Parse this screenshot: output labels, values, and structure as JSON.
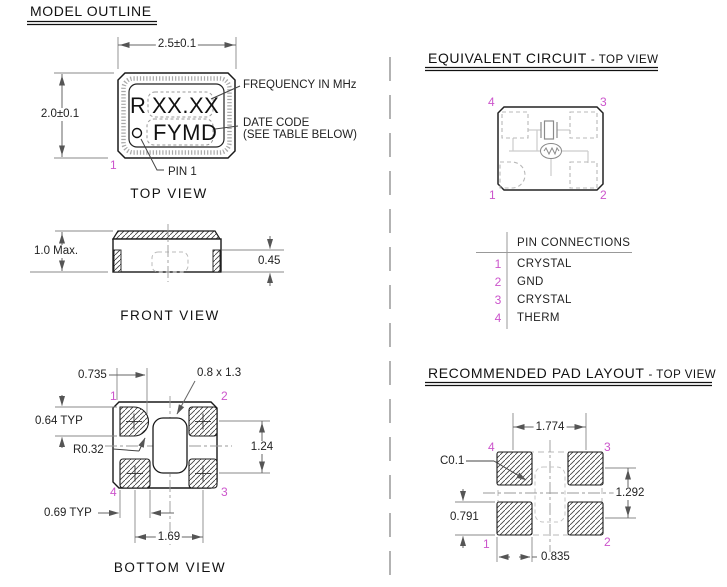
{
  "colors": {
    "object_line": "#1a1a1a",
    "dimension_line": "#666666",
    "pin_number": "#cc55cc",
    "trace": "#cccccc"
  },
  "model_outline": {
    "title": "MODEL OUTLINE"
  },
  "top_view": {
    "caption": "TOP VIEW",
    "width_dim": "2.5±0.1",
    "height_dim": "2.0±0.1",
    "marking_prefix": "R",
    "marking_frequency": "XX.XX",
    "marking_datecode": "FYMD",
    "label_frequency": "FREQUENCY IN MHz",
    "label_datecode_line1": "DATE CODE",
    "label_datecode_line2": "(SEE TABLE BELOW)",
    "label_pin1": "PIN 1",
    "pin1": "1"
  },
  "front_view": {
    "caption": "FRONT VIEW",
    "height_dim": "1.0 Max.",
    "castellation_dim": "0.45"
  },
  "bottom_view": {
    "caption": "BOTTOM VIEW",
    "dim_pad_offset": "0.735",
    "dim_cavity": "0.8 x 1.3",
    "dim_pad_height": "0.64 TYP",
    "dim_corner_radius": "R0.32",
    "dim_row_pitch": "1.24",
    "dim_pad_width": "0.69 TYP",
    "dim_col_pitch": "1.69",
    "pin_tl": "1",
    "pin_tr": "2",
    "pin_br": "3",
    "pin_bl": "4"
  },
  "equivalent_circuit": {
    "title": "EQUIVALENT CIRCUIT",
    "subtitle": "- TOP VIEW",
    "pin_tl": "4",
    "pin_tr": "3",
    "pin_bl": "1",
    "pin_br": "2"
  },
  "pin_connections": {
    "header": "PIN CONNECTIONS",
    "rows": [
      {
        "pin": "1",
        "name": "CRYSTAL"
      },
      {
        "pin": "2",
        "name": "GND"
      },
      {
        "pin": "3",
        "name": "CRYSTAL"
      },
      {
        "pin": "4",
        "name": "THERM"
      }
    ]
  },
  "pad_layout": {
    "title": "RECOMMENDED PAD LAYOUT",
    "subtitle": "- TOP VIEW",
    "dim_col_pitch": "1.774",
    "dim_chamfer": "C0.1",
    "dim_row_pitch": "1.292",
    "dim_pad_height": "0.791",
    "dim_pad_width": "0.835",
    "pin_tl": "4",
    "pin_tr": "3",
    "pin_bl": "1",
    "pin_br": "2"
  }
}
